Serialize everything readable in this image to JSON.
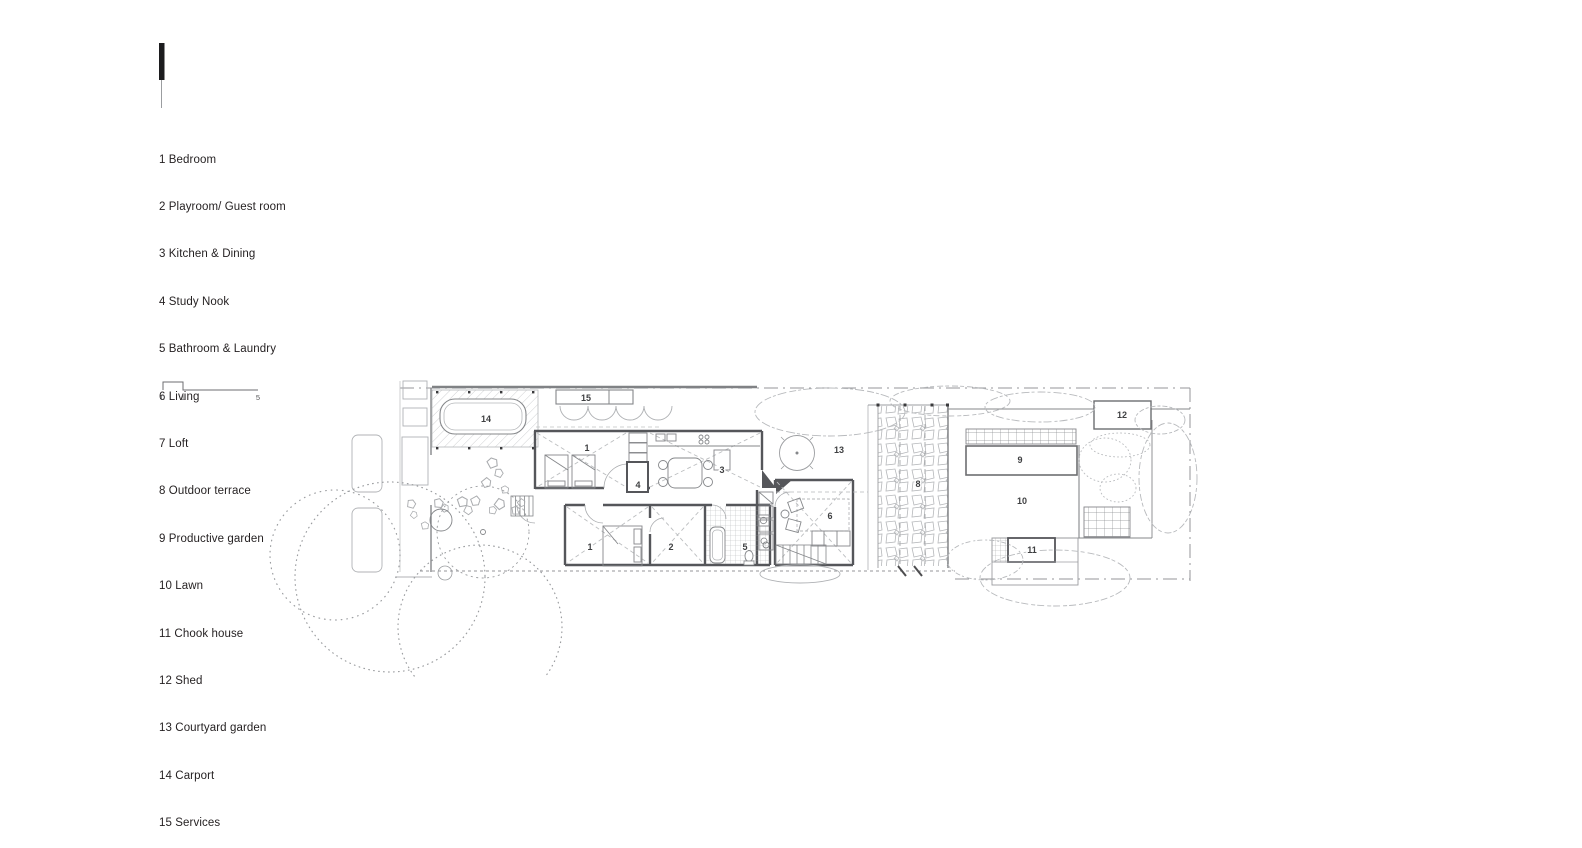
{
  "drawing": {
    "type": "residential ground floor site plan",
    "colors": {
      "ink": "#231f20",
      "wall": "#55565a",
      "line_mid": "#85878a",
      "line_light": "#aeb0b3",
      "vegetation": "#b8babd",
      "north_marker": "#1c1c1e"
    }
  },
  "legend": {
    "items": [
      "1 Bedroom",
      "2 Playroom/ Guest room",
      "3 Kitchen & Dining",
      "4 Study Nook",
      "5 Bathroom & Laundry",
      "6 Living",
      "7 Loft",
      "8 Outdoor terrace",
      "9 Productive garden",
      "10 Lawn",
      "11 Chook house",
      "12 Shed",
      "13 Courtyard garden",
      "14 Carport",
      "15 Services"
    ]
  },
  "scale_bar": {
    "ticks": [
      "0",
      "1",
      "5"
    ]
  },
  "plan": {
    "labels": [
      {
        "t": "14",
        "room": "Carport"
      },
      {
        "t": "15",
        "room": "Services"
      },
      {
        "t": "1",
        "room": "Bedroom"
      },
      {
        "t": "4",
        "room": "Study Nook"
      },
      {
        "t": "3",
        "room": "Kitchen & Dining"
      },
      {
        "t": "13",
        "room": "Courtyard garden"
      },
      {
        "t": "6",
        "room": "Living"
      },
      {
        "t": "8",
        "room": "Outdoor terrace"
      },
      {
        "t": "9",
        "room": "Productive garden"
      },
      {
        "t": "10",
        "room": "Lawn"
      },
      {
        "t": "12",
        "room": "Shed"
      },
      {
        "t": "11",
        "room": "Chook house"
      },
      {
        "t": "1",
        "room": "Bedroom"
      },
      {
        "t": "2",
        "room": "Playroom/ Guest room"
      },
      {
        "t": "5",
        "room": "Bathroom & Laundry"
      }
    ]
  }
}
